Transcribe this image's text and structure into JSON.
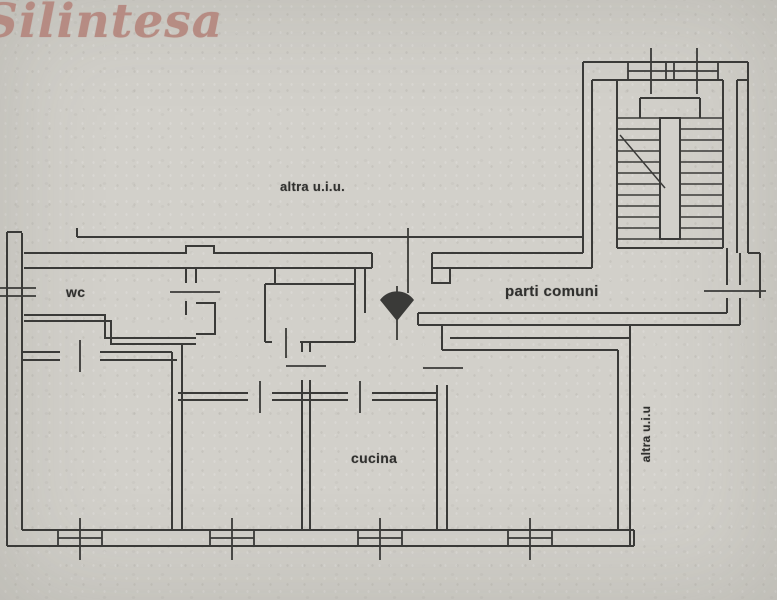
{
  "page": {
    "paper_color": "#d2d0ca",
    "ink_color": "#3a3a38"
  },
  "logo": {
    "text": "Silintesa",
    "color": "#b4847b"
  },
  "floorplan": {
    "labels": {
      "altra_uiu_top": "altra u.i.u.",
      "wc": "wc",
      "parti_comuni": "parti comuni",
      "cucina": "cucina",
      "altra_uiu_right": "altra u.i.u"
    }
  }
}
